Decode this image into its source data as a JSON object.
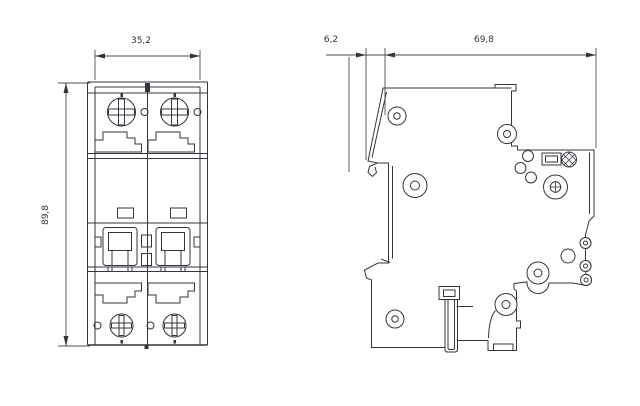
{
  "drawing": {
    "description": "Dimension drawing of a 2-pole DIN-rail miniature circuit breaker, front view and side view",
    "colors": {
      "line": "#30363b",
      "dimension_line": "#494f54",
      "background": "#ffffff"
    },
    "front_view": {
      "width_label": "35,2",
      "height_label": "89,8"
    },
    "side_view": {
      "claw_depth_label": "6,2",
      "body_depth_label": "69,8"
    }
  }
}
